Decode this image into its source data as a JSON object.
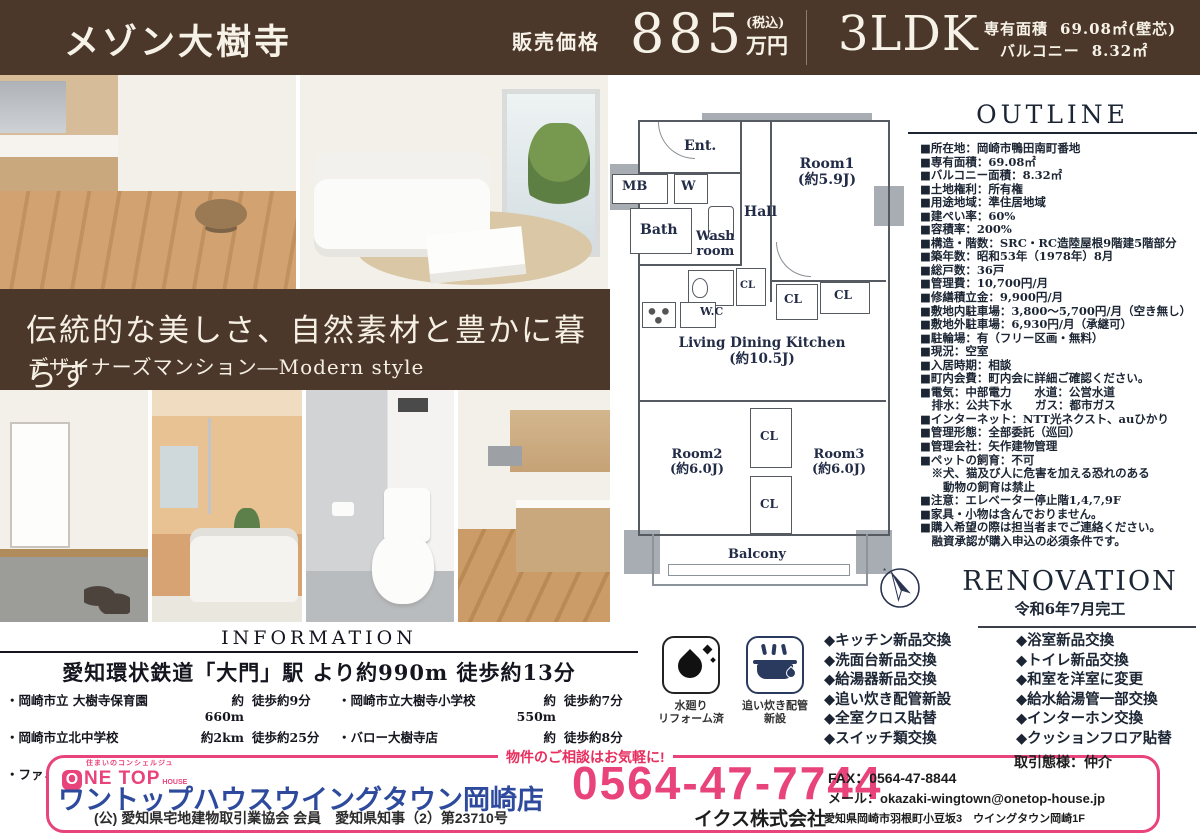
{
  "colors": {
    "header_brown": "#4b382a",
    "accent_pink": "#e8437a",
    "store_blue": "#2e4a9d",
    "plan_navy": "#232c47",
    "list_navy": "#1c2533"
  },
  "header": {
    "title": "メゾン大樹寺",
    "price_label": "販売価格",
    "price_value": "885",
    "price_tax": "(税込)",
    "price_unit": "万円",
    "layout": "3LDK",
    "area_label": "専有面積",
    "area_value": "69.08㎡(壁芯)",
    "balcony_label": "バルコニー",
    "balcony_value": "8.32㎡"
  },
  "banner": {
    "headline": "伝統的な美しさ、自然素材と豊かに暮らす",
    "subline": "デザイナーズマンション―Modern style"
  },
  "floorplan": {
    "labels": {
      "ent": "Ent.",
      "mb": "MB",
      "w": "W",
      "bath": "Bath",
      "washroom": "Wash\nroom",
      "hall": "Hall",
      "wc": "W.C",
      "room1": "Room1\n(約5.9J)",
      "ldk": "Living Dining Kitchen\n(約10.5J)",
      "room2": "Room2\n(約6.0J)",
      "room3": "Room3\n(約6.0J)",
      "cl": "CL",
      "balcony": "Balcony"
    }
  },
  "outline": {
    "heading": "OUTLINE",
    "items": [
      "■所在地：岡崎市鴨田南町番地",
      "■専有面積：69.08㎡",
      "■バルコニー面積：8.32㎡",
      "■土地権利：所有権",
      "■用途地域：準住居地域",
      "■建ぺい率：60%",
      "■容積率：200%",
      "■構造・階数：SRC・RC造陸屋根9階建5階部分",
      "■築年数：昭和53年（1978年）8月",
      "■総戸数：36戸",
      "■管理費：10,700円/月",
      "■修繕積立金：9,900円/月",
      "■敷地内駐車場：3,800～5,700円/月（空き無し）",
      "■敷地外駐車場：6,930円/月（承継可）",
      "■駐輪場：有（フリー区画・無料）",
      "■現況：空室",
      "■入居時期：相談",
      "■町内会費：町内会に詳細ご確認ください。",
      "■電気：中部電力　　水道：公営水道",
      "　排水：公共下水　　ガス：都市ガス",
      "■インターネット：NTT光ネクスト、auひかり",
      "■管理形態：全部委託（巡回）",
      "■管理会社：矢作建物管理",
      "■ペットの飼育：不可",
      "　※犬、猫及び人に危害を加える恐れのある",
      "　　動物の飼育は禁止",
      "■注意：エレベーター停止階1,4,7,9F",
      "■家具・小物は含んでおりません。",
      "■購入希望の際は担当者までご連絡ください。",
      "　融資承認が購入申込の必須条件です。"
    ]
  },
  "renovation_stamp": {
    "heading": "RENOVATION",
    "completed": "令和6年7月完工"
  },
  "information": {
    "heading": "INFORMATION",
    "access": "愛知環状鉄道「大門」駅 より約990m 徒歩約13分",
    "places": [
      {
        "name": "・岡崎市立 大樹寺保育園",
        "distance": "約660m",
        "walk": "徒歩約9分"
      },
      {
        "name": "・岡崎市立大樹寺小学校",
        "distance": "約550m",
        "walk": "徒歩約7分"
      },
      {
        "name": "・岡崎市立北中学校",
        "distance": "約2km",
        "walk": "徒歩約25分"
      },
      {
        "name": "・バロー大樹寺店",
        "distance": "約610m",
        "walk": "徒歩約8分"
      },
      {
        "name": "・ファミリーマート岡崎鴨田東店",
        "distance": "約160m",
        "walk": "徒歩約2分"
      },
      {
        "name": "・スギドラック大樹寺店",
        "distance": "約480m",
        "walk": "徒歩約6分"
      }
    ]
  },
  "badges": [
    {
      "icon": "water-drop-icon",
      "caption": [
        "水廻り",
        "リフォーム済"
      ]
    },
    {
      "icon": "bathtub-icon",
      "caption": [
        "追い炊き配管",
        "新設"
      ]
    }
  ],
  "renovation_list": {
    "left": [
      "◆キッチン新品交換",
      "◆洗面台新品交換",
      "◆給湯器新品交換",
      "◆追い炊き配管新設",
      "◆全室クロス貼替",
      "◆スイッチ類交換"
    ],
    "right": [
      "◆浴室新品交換",
      "◆トイレ新品交換",
      "◆和室を洋室に変更",
      "◆給水給湯管一部交換",
      "◆インターホン交換",
      "◆クッションフロア貼替"
    ]
  },
  "footer": {
    "tagline": "物件のご相談はお気軽に!",
    "logo_small": "住まいのコンシェルジュ",
    "logo_o": "O",
    "logo_rest": "NE TOP",
    "logo_house": "HOUSE",
    "store_name": "ワントップハウスウイングタウン岡崎店",
    "license": "(公) 愛知県宅地建物取引業協会 会員　愛知県知事（2）第23710号",
    "phone": "0564-47-7744",
    "fax": "FAX：0564-47-8844",
    "email": "メール：okazaki-wingtown@onetop-house.jp",
    "deal_type": "取引態様：仲介",
    "company": "イクス株式会社",
    "address": "愛知県岡崎市羽根町小豆坂3　ウイングタウン岡崎1F"
  }
}
